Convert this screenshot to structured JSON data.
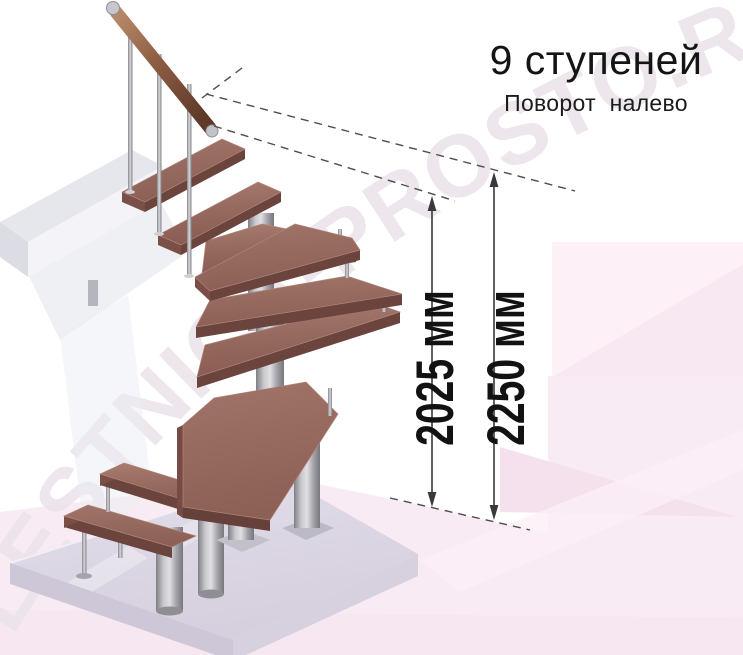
{
  "header": {
    "title": "9 ступеней",
    "subtitle": "Поворот налево"
  },
  "dimensions": {
    "inner": {
      "label": "2025 мм"
    },
    "outer": {
      "label": "2250 мм"
    }
  },
  "watermark": {
    "text": "LESTNICA-PROSTO.RU"
  },
  "illustration": {
    "steps": 9,
    "turn_direction": "налево"
  },
  "colors": {
    "tread_wood": "#96675e",
    "tread_edge": "#6b443d",
    "metal_gray": "#a9a9af",
    "handrail_wood": "#9a6a50",
    "floor_platform": "#dcd6e2",
    "background_pink": "#f9ebf3",
    "dimension_line": "#3c3c42",
    "text": "#161616"
  }
}
